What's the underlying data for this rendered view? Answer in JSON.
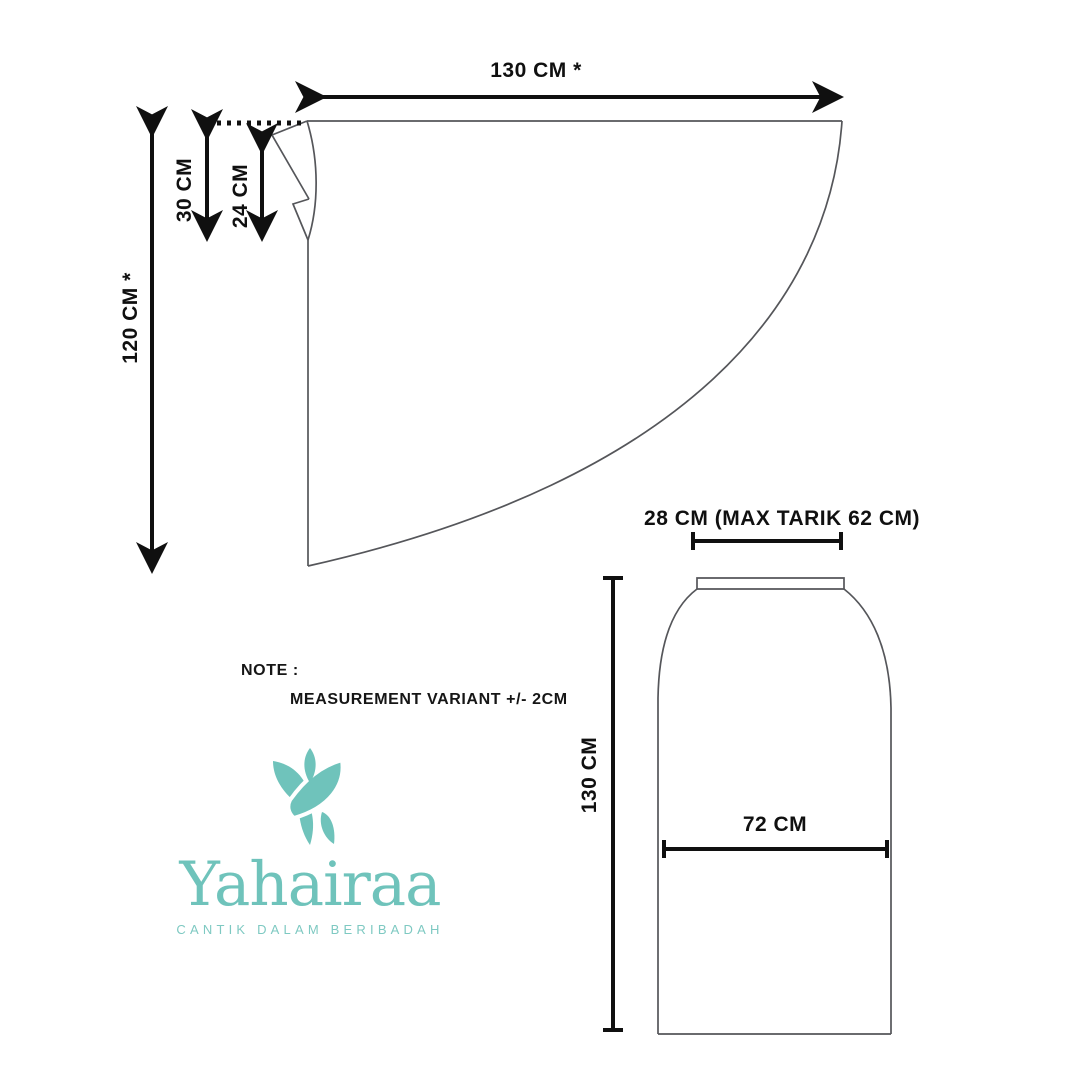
{
  "brand": {
    "name": "Yahairaa",
    "tagline": "CANTIK DALAM BERIBADAH",
    "accent_color": "#6fc3bb",
    "icon": "leaf-monogram-icon"
  },
  "note": {
    "label": "NOTE :",
    "text": "MEASUREMENT VARIANT +/- 2CM"
  },
  "top_piece": {
    "name": "mukena top pattern (quarter-circle)",
    "width_label": "130 CM *",
    "height_label": "120 CM *",
    "neck_outer_label": "30 CM",
    "neck_inner_label": "24 CM"
  },
  "skirt_piece": {
    "name": "mukena skirt pattern",
    "waist_label": "28 CM (MAX TARIK 62 CM)",
    "length_label": "130 CM",
    "hip_label": "72 CM"
  }
}
